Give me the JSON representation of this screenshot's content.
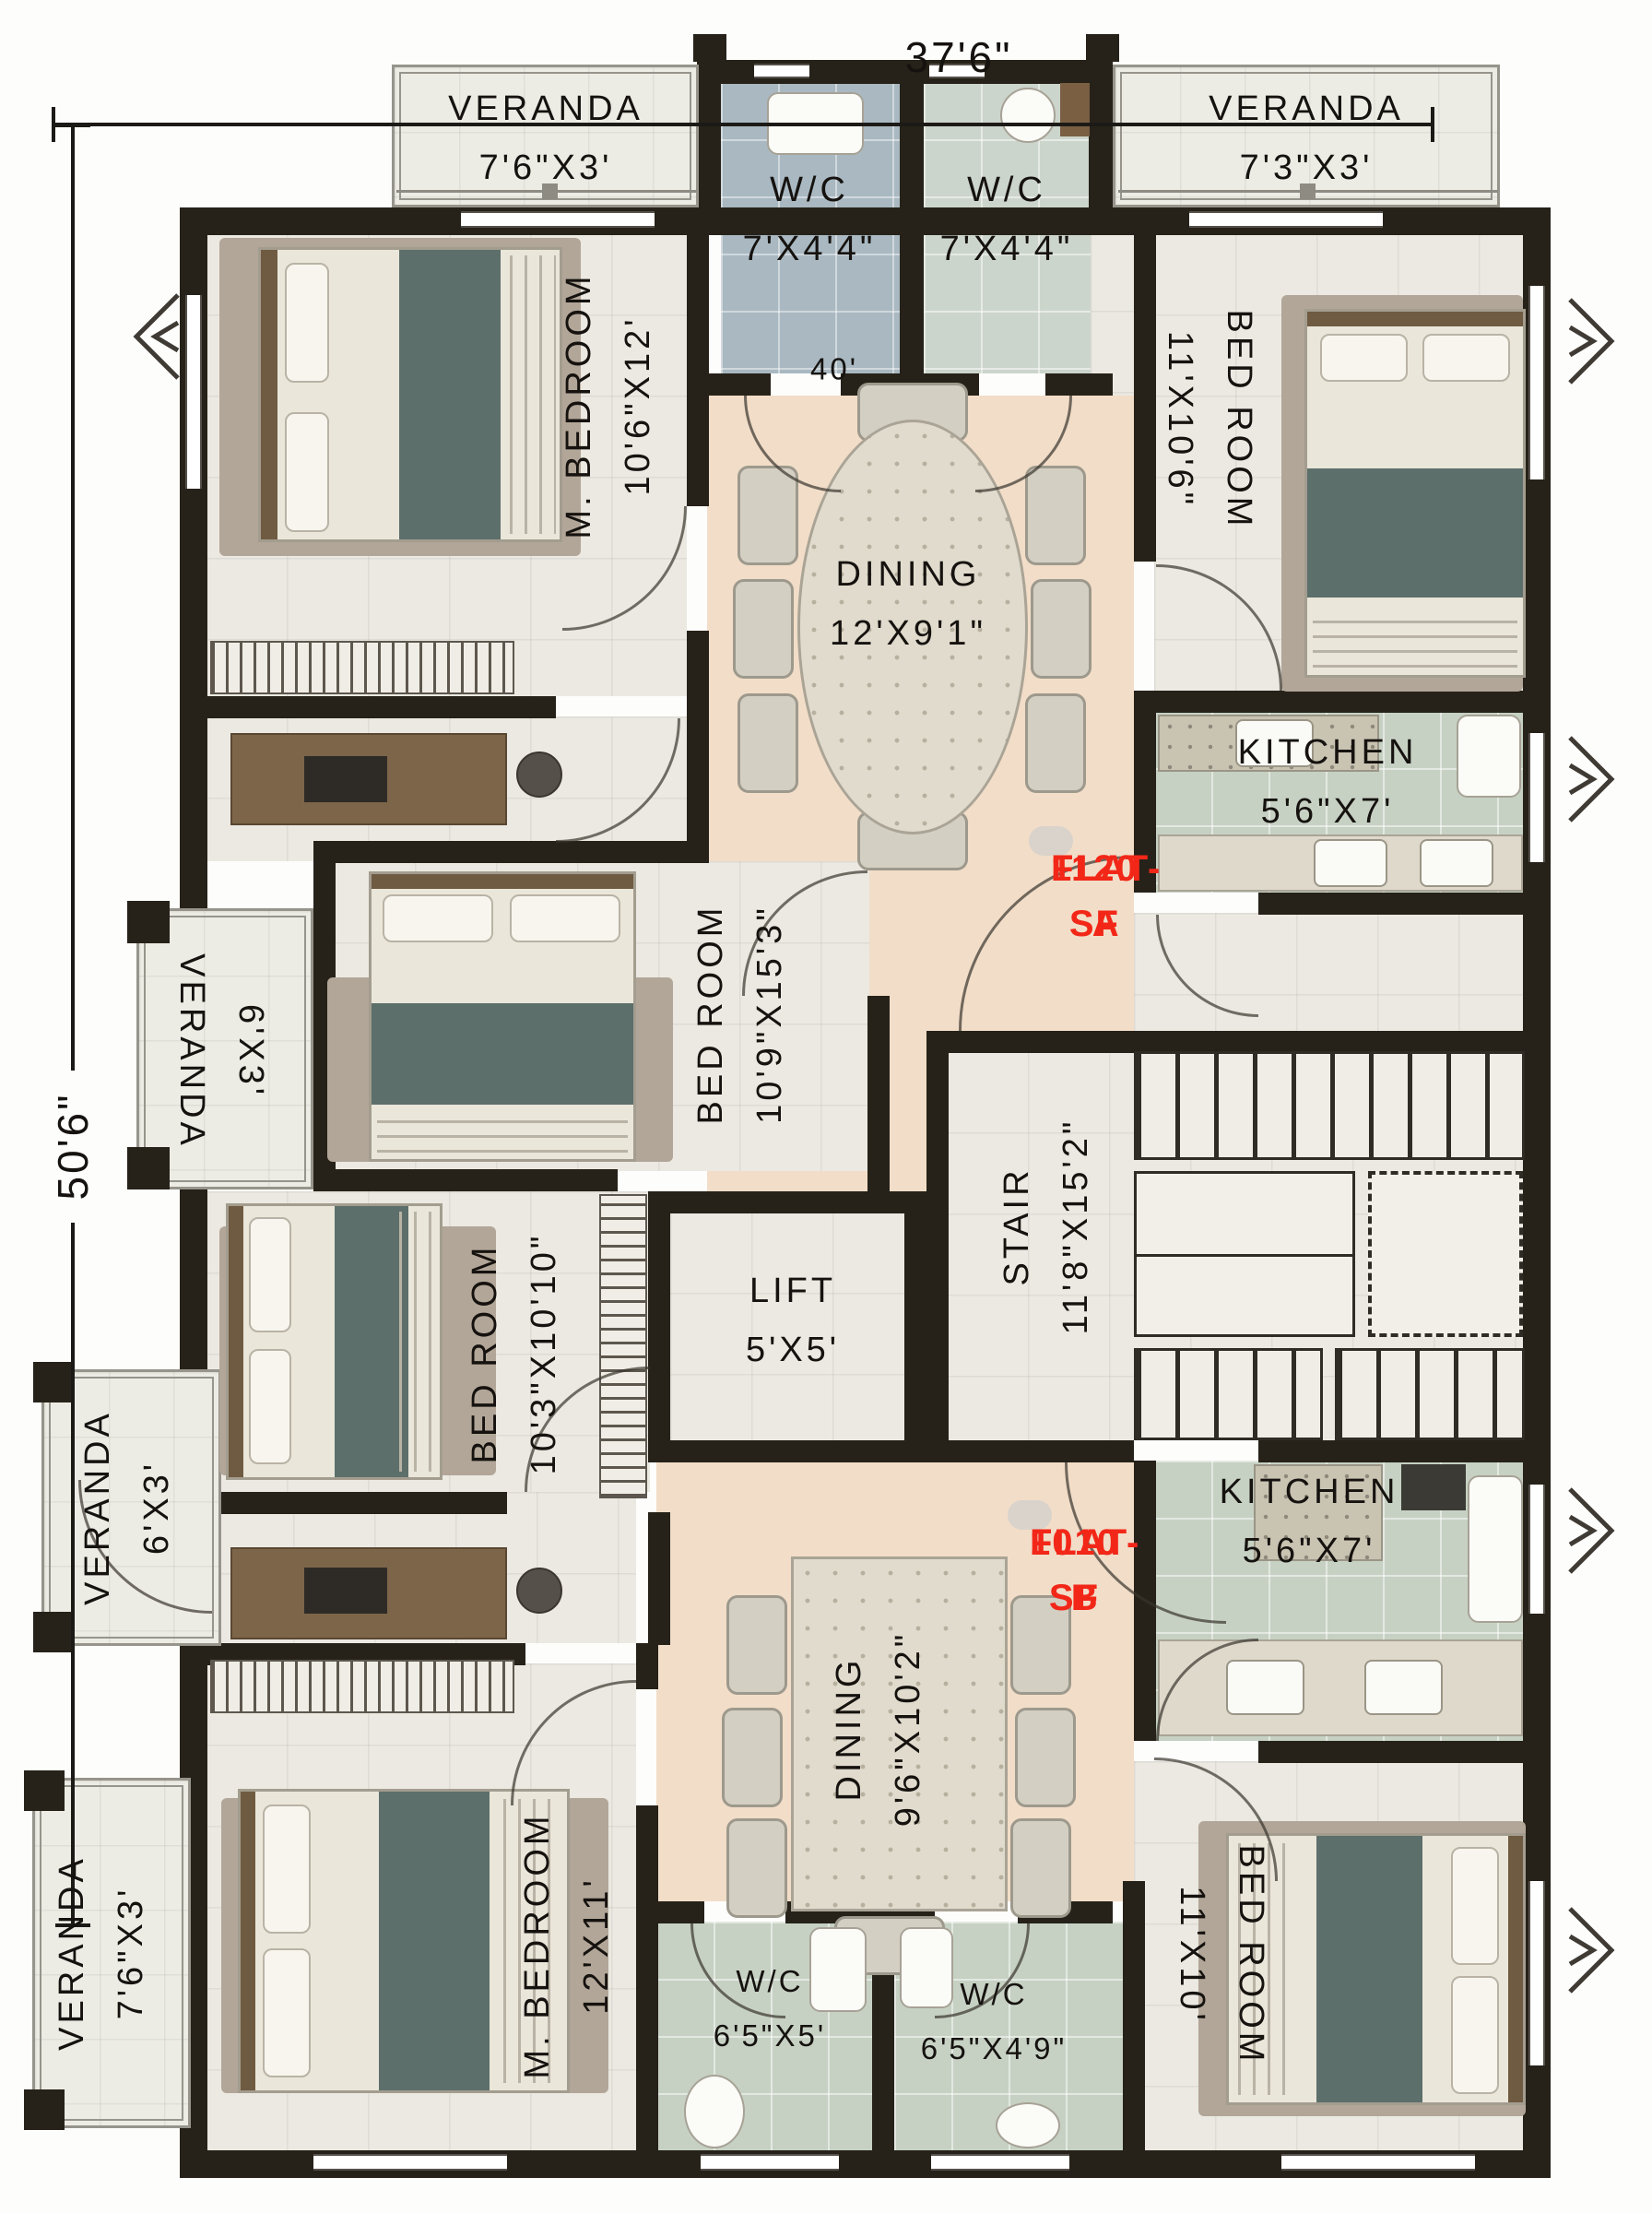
{
  "dimensions": {
    "top": "37'6\"",
    "left": "50'6\"",
    "interior": "40'"
  },
  "flat_a": {
    "badge": {
      "name": "FLAT-A",
      "area": "1120 SF"
    },
    "veranda_top_left": {
      "name": "VERANDA",
      "size": "7'6\"X3'"
    },
    "wc_left": {
      "name": "W/C",
      "size": "7'X4'4\""
    },
    "wc_right": {
      "name": "W/C",
      "size": "7'X4'4\""
    },
    "veranda_top_right": {
      "name": "VERANDA",
      "size": "7'3\"X3'"
    },
    "master_bedroom": {
      "name": "M. BEDROOM",
      "size": "10'6\"X12'"
    },
    "bedroom_right": {
      "name": "BED ROOM",
      "size": "11'X10'6\""
    },
    "dining": {
      "name": "DINING",
      "size": "12'X9'1\""
    },
    "kitchen": {
      "name": "KITCHEN",
      "size": "5'6\"X7'"
    },
    "bedroom_middle": {
      "name": "BED ROOM",
      "size": "10'9\"X15'3\""
    },
    "veranda_left": {
      "name": "VERANDA",
      "size": "6'X3'"
    }
  },
  "common": {
    "lift": {
      "name": "LIFT",
      "size": "5'X5'"
    },
    "stair": {
      "name": "STAIR",
      "size": "11'8\"X15'2\""
    }
  },
  "flat_b": {
    "badge": {
      "name": "FLAT-B",
      "area": "1010 SF"
    },
    "bedroom_left": {
      "name": "BED ROOM",
      "size": "10'3\"X10'10\""
    },
    "veranda_left": {
      "name": "VERANDA",
      "size": "6'X3'"
    },
    "dining": {
      "name": "DINING",
      "size": "9'6\"X10'2\""
    },
    "kitchen": {
      "name": "KITCHEN",
      "size": "5'6\"X7'"
    },
    "master_bedroom": {
      "name": "M. BEDROOM",
      "size": "12'X11'"
    },
    "wc_left": {
      "name": "W/C",
      "size": "6'5\"X5'"
    },
    "wc_right": {
      "name": "W/C",
      "size": "6'5\"X4'9\""
    },
    "bedroom_right": {
      "name": "BED ROOM",
      "size": "11'X10'"
    },
    "veranda_bottom": {
      "name": "VERANDA",
      "size": "7'6\"X3'"
    }
  },
  "colors": {
    "wall": "#262219",
    "flat_label_red": "#f22718",
    "dining_floor": "#f2ddc8",
    "kitchen_floor": "#c6d1c3",
    "wc_blue_floor": "#a9b8c1",
    "bedroom_floor": "#ebe9e1",
    "blanket_teal": "#5d6f6a"
  }
}
